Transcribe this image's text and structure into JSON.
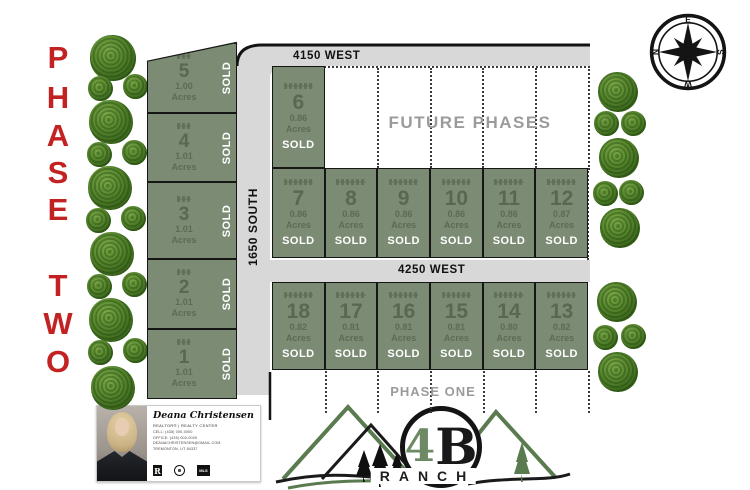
{
  "phase_two": {
    "letters": [
      "P",
      "H",
      "A",
      "S",
      "E",
      "T",
      "W",
      "O"
    ]
  },
  "roads": {
    "top": "4150 WEST",
    "middle": "4250 WEST",
    "left_vertical": "1650 SOUTH"
  },
  "labels": {
    "future_phases": "FUTURE PHASES",
    "phase_one": "PHASE ONE"
  },
  "compass": {
    "n": "N",
    "e": "E",
    "s": "S",
    "w": "W"
  },
  "lots": {
    "sold": "SOLD",
    "acres_word": "Acres",
    "left_column": [
      {
        "number": "5",
        "acres": "1.00"
      },
      {
        "number": "4",
        "acres": "1.01"
      },
      {
        "number": "3",
        "acres": "1.01"
      },
      {
        "number": "2",
        "acres": "1.01"
      },
      {
        "number": "1",
        "acres": "1.01"
      }
    ],
    "lot_6": {
      "number": "6",
      "acres": "0.86"
    },
    "middle_row": [
      {
        "number": "7",
        "acres": "0.86"
      },
      {
        "number": "8",
        "acres": "0.86"
      },
      {
        "number": "9",
        "acres": "0.86"
      },
      {
        "number": "10",
        "acres": "0.86"
      },
      {
        "number": "11",
        "acres": "0.86"
      },
      {
        "number": "12",
        "acres": "0.87"
      }
    ],
    "bottom_row": [
      {
        "number": "18",
        "acres": "0.82"
      },
      {
        "number": "17",
        "acres": "0.81"
      },
      {
        "number": "16",
        "acres": "0.81"
      },
      {
        "number": "15",
        "acres": "0.81"
      },
      {
        "number": "14",
        "acres": "0.80"
      },
      {
        "number": "13",
        "acres": "0.82"
      }
    ]
  },
  "logo": {
    "number": "4",
    "letter": "B",
    "name": "RANCH"
  },
  "agent": {
    "name": "Deana Christensen",
    "title": "REALTOR® | REALTY CENTER",
    "lines": [
      "CELL: (435) 000-0000",
      "OFFICE: (435) 000-0000",
      "DEANACHRISTENSEN@GMAIL.COM",
      "TREMONTON, UT 84337"
    ]
  },
  "colors": {
    "lot_green": "#7c8b74",
    "road_gray": "#d8d8d8",
    "phase_red": "#c32222",
    "ghost_gray": "#9b9b9b"
  }
}
